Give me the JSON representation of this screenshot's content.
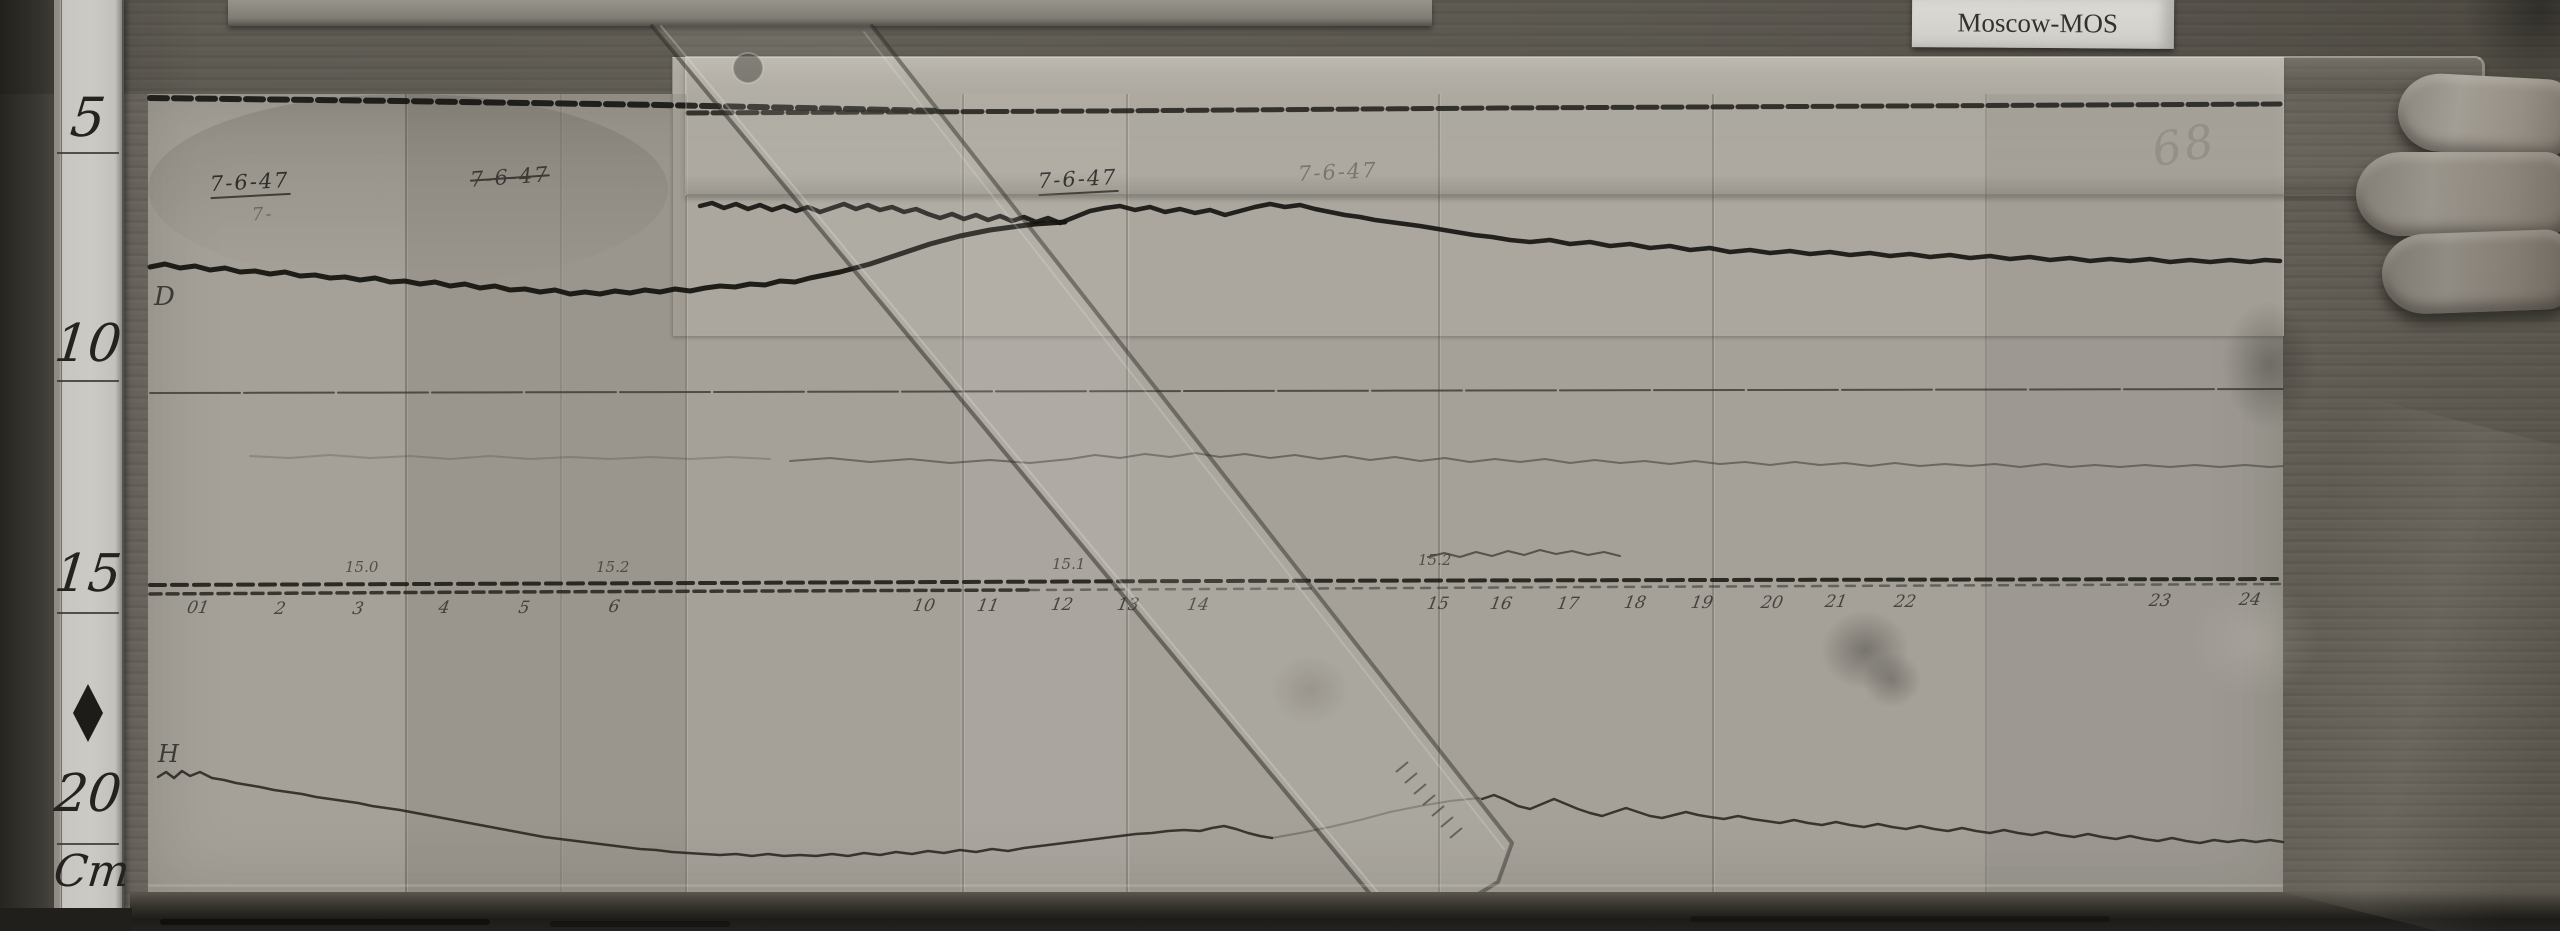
{
  "scene": {
    "station_label": "Moscow-MOS",
    "sheet_number": "68"
  },
  "cm_ruler": {
    "marks": [
      "5",
      "10",
      "15",
      "20"
    ],
    "unit_label": "Cm"
  },
  "annotations": {
    "trace_d": "D",
    "trace_h": "H",
    "date_1": "7-6-47",
    "date_1b": "7-",
    "date_2": "7-6-47",
    "date_3": "7-6-47",
    "date_4": "7-6-47",
    "scale_1": "15.0",
    "scale_2": "15.2",
    "scale_3": "15.1",
    "scale_4": "15.2",
    "hours": [
      "01",
      "2",
      "3",
      "4",
      "5",
      "6",
      "10",
      "11",
      "12",
      "13",
      "14",
      "15",
      "16",
      "17",
      "18",
      "19",
      "20",
      "21",
      "22",
      "23",
      "24"
    ]
  },
  "colors": {
    "paper": "#a5a199",
    "wood": "#6e6a62",
    "trace_ink": "#14130f",
    "card": "#d3d2cd"
  },
  "traces": {
    "top_edge_left": "150,98 400,101 660,105 850,109 940,111",
    "top_edge_right": "688,113 1100,111 1500,108 1900,106 2280,104",
    "d_left": "150,267 165,264 180,268 195,266 210,270 225,268 240,272 255,271 270,274 285,272 300,276 315,275 330,278 345,277 360,280 375,278 390,282 405,281 420,284 435,282 450,286 465,284 480,288 495,286 510,290 525,289 540,292 555,290 570,294 585,292 600,294 615,291 630,293 645,290 660,292 675,289 690,291 705,288 720,286 735,287 750,284 765,285 780,281 795,282 810,278 825,275 840,272 855,268 870,264 885,259 900,254 915,249 930,244 945,240 960,236 975,233 990,230 1005,228 1020,226 1035,224 1050,223 1065,222",
    "d_right": "700,206 712,203 724,208 736,204 748,209 760,205 772,210 784,206 796,211 808,207 820,212 832,208 844,204 856,209 868,205 880,210 892,207 904,212 916,209 928,214 940,218 952,214 964,219 976,215 988,220 1000,216 1012,221 1024,217 1036,222 1048,218 1060,223 1075,217 1090,211 1105,208 1120,206 1135,210 1150,207 1165,212 1180,209 1195,213 1210,210 1225,215 1240,211 1255,207 1270,204 1285,207 1300,205 1315,209 1330,212 1345,215 1360,217 1375,220 1390,222 1405,224 1420,226 1438,229 1456,232 1474,235 1492,237 1510,240 1530,242 1550,240 1570,244 1590,242 1610,246 1630,244 1650,248 1670,246 1690,250 1710,248 1730,252 1750,250 1770,253 1790,251 1810,254 1830,252 1850,255 1870,253 1890,256 1910,254 1930,257 1950,255 1970,258 1990,256 2010,259 2030,257 2050,260 2070,258 2090,261 2110,259 2130,261 2150,259 2170,262 2190,260 2210,262 2230,260 2250,262 2265,260 2280,261",
    "d_baseline": "150,393 2283,389",
    "mid_faint_left": "250,456 290,458 330,455 370,458 410,456 450,459 490,456 530,459 570,457 610,459 650,457 690,459 730,457 770,459",
    "mid_faint_right": "790,461 830,458 870,462 910,459 950,463 990,460 1030,463 1070,459 1095,455 1120,458 1145,454 1170,457 1195,453 1220,457 1245,454 1270,458 1295,455 1320,459 1345,456 1370,460 1395,457 1420,461 1445,458 1470,462 1495,459 1520,462 1545,459 1570,463 1595,460 1620,463 1645,461 1670,464 1695,461 1720,464 1745,462 1770,465 1795,462 1820,465 1845,463 1870,466 1895,463 1920,466 1945,464 1970,466 1995,464 2020,467 2045,464 2070,467 2095,465 2120,467 2145,465 2170,467 2195,465 2220,467 2245,465 2270,467 2283,466",
    "pre_base": "1428,557 1444,553 1460,557 1476,552 1492,556 1508,551 1524,555 1540,550 1556,554 1572,551 1588,555 1604,552 1620,556",
    "baseline_1": "150,585 700,583 1200,581 1700,580 2283,579",
    "baseline_2": "150,594 500,592 1030,590",
    "baseline_3": "1030,590 1600,587 2283,584",
    "h_main": "158,777 166,772 174,778 182,771 190,776 200,772 212,778 224,780 236,783 248,785 260,787 274,790 288,792 302,794 316,797 330,799 344,801 358,803 372,806 386,808 400,810 416,813 432,816 448,819 464,822 480,825 496,828 512,831 528,834 544,837 560,839 576,841 592,843 608,845 624,847 640,849 656,850 672,852 688,853 704,854 720,855 736,854 752,856 768,854 784,856 800,855 816,856 832,854 848,856 864,853 880,855 896,852 912,854 928,851 944,853 960,850 976,852 992,849 1008,851 1024,848 1040,846 1056,844 1072,842 1088,840 1104,838 1120,836 1136,834 1152,833 1168,831 1184,830 1200,831 1212,828 1224,826 1236,829 1248,833 1260,836 1272,838",
    "h_under_ruler": "1272,838 1300,833 1330,827 1360,820 1390,812 1420,806 1450,801 1480,798",
    "h_right": "1482,799 1494,795 1506,800 1518,806 1530,809 1542,804 1554,799 1566,804 1578,809 1590,813 1602,816 1614,812 1626,808 1638,812 1650,816 1662,818 1674,815 1686,812 1698,815 1710,817 1724,819 1738,816 1752,819 1766,821 1780,823 1794,820 1808,823 1822,825 1836,822 1850,825 1864,827 1878,824 1892,827 1906,829 1920,826 1934,829 1948,831 1962,828 1976,831 1990,833 2004,830 2018,833 2032,835 2046,832 2060,835 2074,837 2088,834 2102,837 2116,839 2130,836 2144,839 2158,841 2172,838 2186,841 2200,843 2214,840 2228,842 2242,840 2256,842 2270,840 2283,842"
  }
}
